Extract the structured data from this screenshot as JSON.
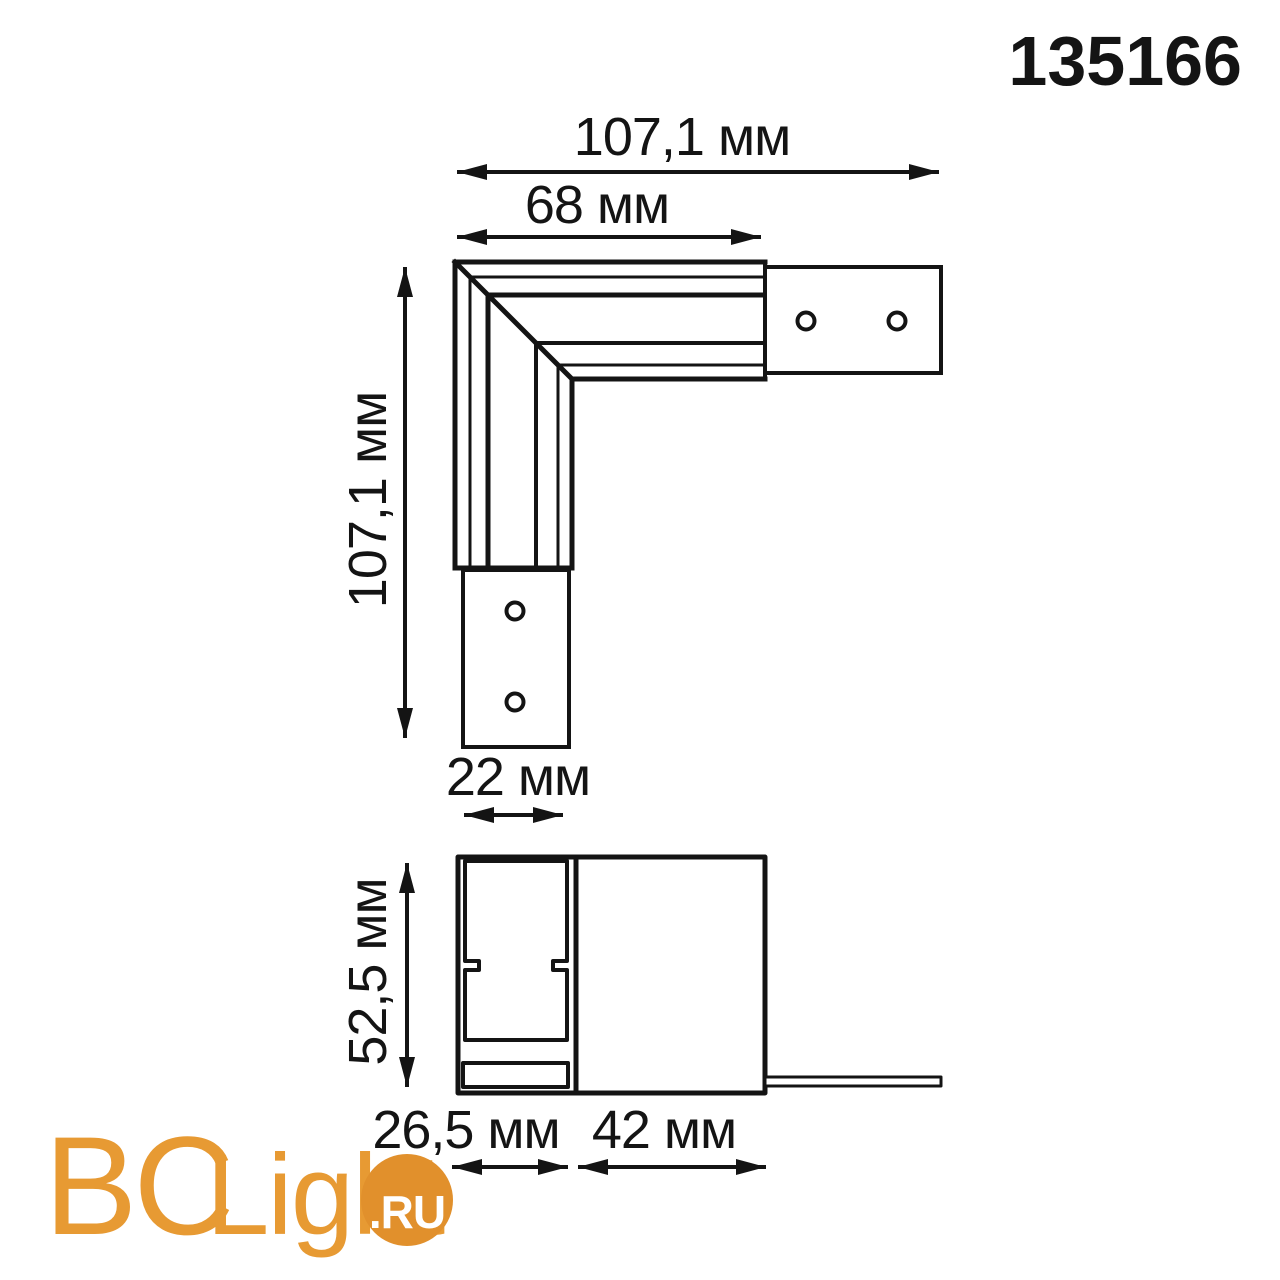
{
  "product": {
    "code": "135166"
  },
  "views": {
    "top_view": {
      "description": "L-shaped track corner connector, top view",
      "dimensions": {
        "overall_width": "107,1 мм",
        "arm_length": "68 мм",
        "overall_height": "107,1 мм",
        "end_plate_width": "22 мм"
      }
    },
    "section_view": {
      "description": "Connector cross-section, side view",
      "dimensions": {
        "height": "52,5 мм",
        "channel_width": "26,5 мм",
        "body_width": "42 мм"
      }
    }
  },
  "logo": {
    "prefix": "BC",
    "name": "Light",
    "suffix": ".RU"
  },
  "colors": {
    "line": "#141414",
    "brand_orange_text": "#e79a33",
    "brand_orange_badge": "#e1902c",
    "logo_suffix_text": "#ffffff"
  }
}
